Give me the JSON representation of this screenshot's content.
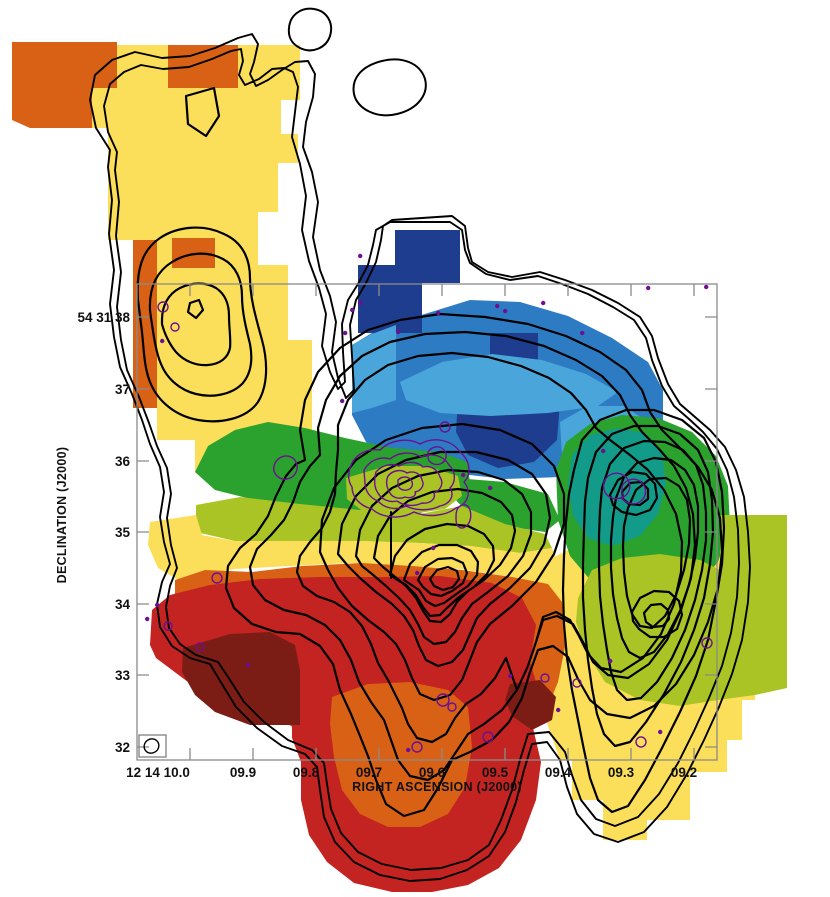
{
  "figure": {
    "x_axis": {
      "label": "RIGHT ASCENSION (J2000)",
      "tick_labels": [
        "12 14 10.0",
        "09.9",
        "09.8",
        "09.7",
        "09.6",
        "09.5",
        "09.4",
        "09.3",
        "09.2"
      ]
    },
    "y_axis": {
      "label": "DECLINATION (J2000)",
      "tick_labels": [
        "54 31 38",
        "37",
        "36",
        "35",
        "34",
        "33",
        "32"
      ]
    }
  },
  "palette": {
    "background": "#ffffff",
    "yellow": "#fbdf5a",
    "orange": "#d96116",
    "red": "#c32321",
    "maroon": "#7c1d15",
    "navy": "#1e3d8e",
    "blue": "#2d7cc3",
    "light_blue": "#4aa5da",
    "teal": "#139b8a",
    "green": "#2ba22e",
    "olive": "#abc425",
    "contour_black": "#000000",
    "contour_purple": "#6c0f93",
    "frame_gray": "#8a8a8a",
    "text": "#111111"
  },
  "chart_data": {
    "type": "heatmap",
    "title": "",
    "xlabel": "RIGHT ASCENSION (J2000)",
    "ylabel": "DECLINATION (J2000)",
    "x_tick_labels": [
      "12 14 10.0",
      "09.9",
      "09.8",
      "09.7",
      "09.6",
      "09.5",
      "09.4",
      "09.3",
      "09.2"
    ],
    "x_tick_values_ra_seconds": [
      10.0,
      9.9,
      9.8,
      9.7,
      9.6,
      9.5,
      9.4,
      9.3,
      9.2
    ],
    "y_tick_labels": [
      "54 31 38",
      "37",
      "36",
      "35",
      "34",
      "33",
      "32"
    ],
    "y_tick_values_dec_arcsec": [
      38,
      37,
      36,
      35,
      34,
      33,
      32
    ],
    "x_axis_range_ra_seconds": [
      10.08,
      9.16
    ],
    "y_axis_range_dec_arcsec": [
      38.5,
      31.8
    ],
    "grid": false,
    "legend_position": "none (no colorbar shown)",
    "colormap_velocity_order_blue_to_red": [
      "#1e3d8e",
      "#2d7cc3",
      "#4aa5da",
      "#139b8a",
      "#2ba22e",
      "#abc425",
      "#fbdf5a",
      "#d96116",
      "#c32321",
      "#7c1d15"
    ],
    "features": [
      {
        "name": "south contour peak",
        "ra": "12 14 09.61",
        "dec": "54 31 34.2"
      },
      {
        "name": "east contour peak",
        "ra": "12 14 09.25",
        "dec": "54 31 34.4"
      },
      {
        "name": "northwest lobe peak",
        "ra": "12 14 09.96",
        "dec": "54 31 38.4"
      },
      {
        "name": "compact purple-contour source",
        "ra": "12 14 09.65",
        "dec": "54 31 35.8"
      },
      {
        "name": "blue-shifted region",
        "location": "north-center of map"
      },
      {
        "name": "red-shifted region",
        "location": "south-center of map, extends below axis frame"
      }
    ],
    "overlays": [
      {
        "name": "integrated-intensity contours",
        "style": "thick nested closed contours",
        "color": "#000000"
      },
      {
        "name": "compact-emission contours",
        "style": "thin small contours and specks",
        "color": "#6c0f93"
      },
      {
        "name": "synthesized-beam",
        "style": "small ellipse in box",
        "location": "bottom-left corner of frame"
      }
    ]
  }
}
